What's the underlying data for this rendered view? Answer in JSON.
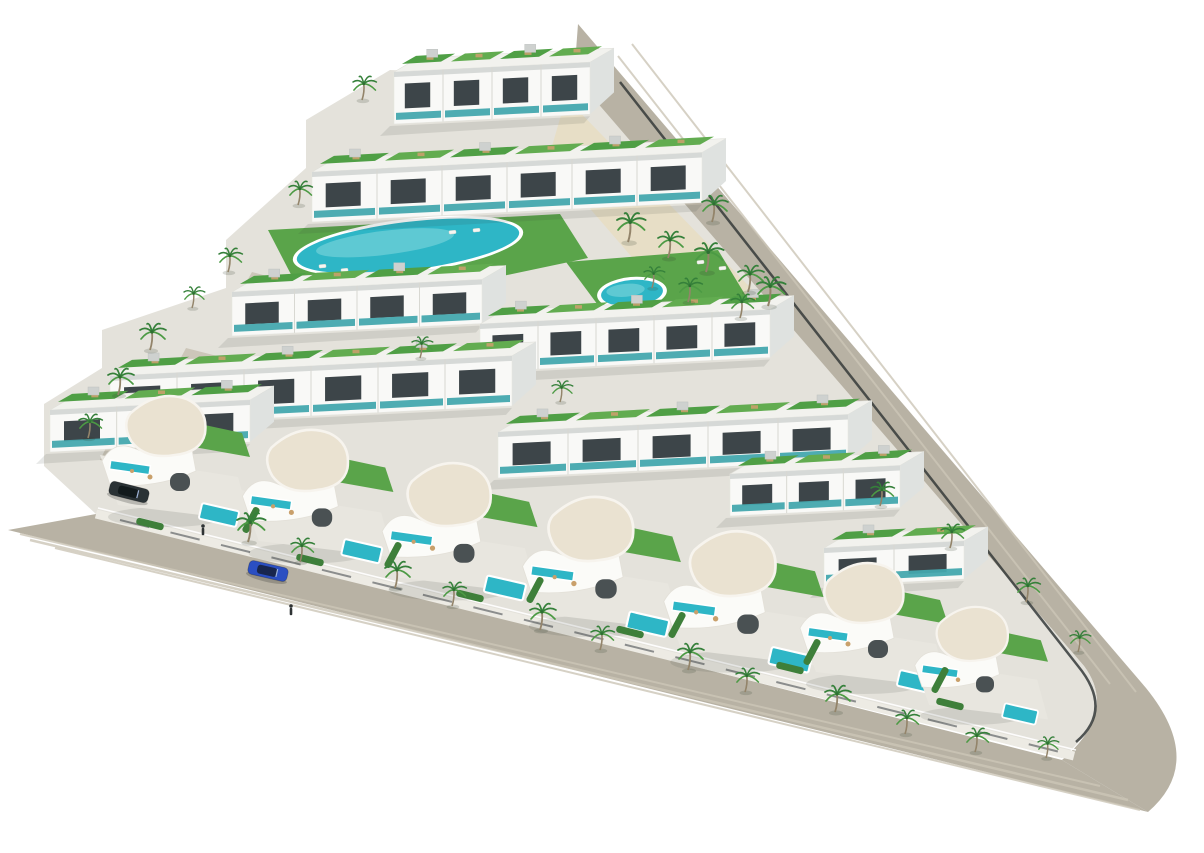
{
  "scene": {
    "alt": "Aerial 3D render of a triangular residential development with rows of white apartments with green roof terraces, two communal pools, curved white villas with private pools, palm trees and perimeter roads",
    "width": 1204,
    "height": 853,
    "palette": {
      "background": "#ffffff",
      "road": "#b8b2a4",
      "road_stripe": "#ccc6b7",
      "plot": "#e4e2db",
      "sidewalk": "#edebe4",
      "sand": "#e7dec6",
      "lawn": "#5aa44a",
      "lawn_dark": "#3e7f3a",
      "roof_green_a": "#4f9f45",
      "roof_green_b": "#62ac50",
      "building": "#f9f9f7",
      "building_side": "#dfe2e0",
      "building_trim": "#d6d9d7",
      "roof_slab": "#f2f2ee",
      "window": "#3d4549",
      "glass_teal": "#44a8ae",
      "pool": "#2eb6c6",
      "pool_light": "#86d9de",
      "pool_rim": "#ffffff",
      "villa_roof": "#eae2d1",
      "villa_wall": "#fbfbf8",
      "terrace": "#e8e6df",
      "palm_frond": "#35803a",
      "palm_frond_light": "#4c9a44",
      "palm_trunk": "#93846a",
      "car_blue": "#2b4fc2",
      "car_blue_glass": "#18264e",
      "car_dark": "#2a3235",
      "car_dark_glass": "#121a1c",
      "fence": "#35393a",
      "furniture_tan": "#c9a06b",
      "lounger_white": "#f6f6f2",
      "shadow": "rgba(60,65,60,0.12)",
      "person": "#2f3335"
    },
    "roads": {
      "right_d": "M 578,24 L 1146,688 Q 1206,762 1148,812 L 1062,760 Q 1118,712 1084,666 L 574,78 Z",
      "bottom_d": "M 8,530 L 1148,812 L 1062,760 L 96,514 Z",
      "stripes": [
        {
          "d": "M 632,44 L 1136,692",
          "w": 2
        },
        {
          "d": "M 618,56 L 1110,684",
          "w": 2
        },
        {
          "d": "M 30,540 L 1128,800",
          "w": 2.5
        },
        {
          "d": "M 55,548 L 1140,810",
          "w": 2
        },
        {
          "d": "M 20,534 L 1100,786",
          "w": 2
        }
      ],
      "sidewalk_d": "M 96,514 L 1074,756",
      "sidewalk_edge_d": "M 98,508 L 1076,750",
      "wall_dash_d": "M 120,520 L 1060,752",
      "fence_d": "M 620,82 L 1078,666 Q 1114,710 1076,742"
    },
    "plot_d": "M 576,78 L 1084,666 Q 1118,712 1062,758 L 96,514 L 44,466 L 44,404 L 102,368 L 102,330 L 226,288 L 226,240 L 306,168 L 306,120 L 390,70 Z",
    "sand_points": "566,98 776,314 700,336 548,160",
    "lawns": [
      {
        "name": "main-pool-lawn",
        "points": "268,230 560,214 588,258 474,282 298,288"
      },
      {
        "name": "round-pool-lawn",
        "points": "566,262 718,250 752,306 612,324"
      }
    ],
    "driveways": [
      "118,424 190,442 172,478 100,460",
      "186,348 256,366 240,400 168,382",
      "252,272 318,290 302,322 234,304"
    ],
    "pools": [
      {
        "name": "main-lap-pool",
        "cx": 408,
        "cy": 246,
        "rx": 112,
        "ry": 24,
        "rot": -7
      },
      {
        "name": "round-pool",
        "cx": 632,
        "cy": 293,
        "rx": 31,
        "ry": 13,
        "rot": -5
      }
    ],
    "loungers": [
      [
        322,
        266
      ],
      [
        344,
        270
      ],
      [
        366,
        274
      ],
      [
        452,
        232
      ],
      [
        476,
        230
      ],
      [
        586,
        312
      ],
      [
        612,
        318
      ],
      [
        648,
        316
      ],
      [
        668,
        306
      ],
      [
        700,
        262
      ],
      [
        722,
        268
      ]
    ],
    "blocks": [
      {
        "name": "apartment-row-a",
        "x": 394,
        "y": 72,
        "w": 196,
        "h": 52,
        "units": 4
      },
      {
        "name": "apartment-row-b",
        "x": 312,
        "y": 172,
        "w": 390,
        "h": 50,
        "units": 6
      },
      {
        "name": "apartment-tower-c",
        "x": 232,
        "y": 292,
        "w": 250,
        "h": 44,
        "units": 4
      },
      {
        "name": "apartment-mid-block",
        "x": 480,
        "y": 324,
        "w": 290,
        "h": 48,
        "units": 5
      },
      {
        "name": "apartment-row-d",
        "x": 110,
        "y": 376,
        "w": 402,
        "h": 50,
        "units": 6
      },
      {
        "name": "apartment-row-d2",
        "x": 498,
        "y": 432,
        "w": 350,
        "h": 46,
        "units": 5
      },
      {
        "name": "apartment-row-e",
        "x": 50,
        "y": 410,
        "w": 200,
        "h": 42,
        "units": 3
      },
      {
        "name": "apartment-row-r1",
        "x": 730,
        "y": 474,
        "w": 170,
        "h": 42,
        "units": 3
      },
      {
        "name": "apartment-row-r2",
        "x": 824,
        "y": 548,
        "w": 140,
        "h": 38,
        "units": 2
      }
    ],
    "villas": [
      {
        "x": 180,
        "y": 455,
        "s": 1.0
      },
      {
        "x": 322,
        "y": 490,
        "s": 1.02
      },
      {
        "x": 464,
        "y": 525,
        "s": 1.05
      },
      {
        "x": 606,
        "y": 560,
        "s": 1.07
      },
      {
        "x": 748,
        "y": 595,
        "s": 1.08
      },
      {
        "x": 878,
        "y": 622,
        "s": 1.0
      },
      {
        "x": 985,
        "y": 660,
        "s": 0.9
      }
    ],
    "hedges": [
      [
        251,
        520,
        -62
      ],
      [
        393,
        555,
        -62
      ],
      [
        535,
        590,
        -62
      ],
      [
        677,
        625,
        -62
      ],
      [
        812,
        652,
        -62
      ],
      [
        940,
        680,
        -62
      ],
      [
        150,
        524,
        14
      ],
      [
        310,
        560,
        14
      ],
      [
        470,
        596,
        14
      ],
      [
        630,
        632,
        14
      ],
      [
        790,
        668,
        14
      ],
      [
        950,
        704,
        14
      ]
    ],
    "palms": [
      [
        362,
        100,
        0.9
      ],
      [
        298,
        205,
        0.9
      ],
      [
        712,
        222,
        1.0
      ],
      [
        228,
        272,
        0.9
      ],
      [
        628,
        242,
        1.1
      ],
      [
        668,
        258,
        1.0
      ],
      [
        706,
        272,
        1.1
      ],
      [
        748,
        292,
        1.0
      ],
      [
        768,
        306,
        1.1
      ],
      [
        740,
        318,
        0.9
      ],
      [
        688,
        302,
        0.9
      ],
      [
        652,
        288,
        0.8
      ],
      [
        150,
        350,
        1.0
      ],
      [
        118,
        395,
        1.0
      ],
      [
        88,
        438,
        0.9
      ],
      [
        192,
        308,
        0.8
      ],
      [
        420,
        358,
        0.8
      ],
      [
        560,
        402,
        0.8
      ],
      [
        248,
        542,
        1.1
      ],
      [
        300,
        562,
        0.9
      ],
      [
        395,
        588,
        1.0
      ],
      [
        452,
        606,
        0.9
      ],
      [
        540,
        630,
        1.0
      ],
      [
        600,
        650,
        0.9
      ],
      [
        688,
        670,
        1.0
      ],
      [
        745,
        692,
        0.9
      ],
      [
        835,
        712,
        1.0
      ],
      [
        905,
        734,
        0.9
      ],
      [
        975,
        752,
        0.9
      ],
      [
        1046,
        758,
        0.8
      ],
      [
        880,
        506,
        0.9
      ],
      [
        950,
        548,
        0.9
      ],
      [
        1026,
        602,
        0.9
      ],
      [
        1078,
        652,
        0.8
      ]
    ],
    "cars": [
      {
        "name": "blue-car",
        "x": 268,
        "y": 571,
        "rot": 13,
        "body": "car_blue",
        "glass": "car_blue_glass"
      },
      {
        "name": "parked-dark-car",
        "x": 129,
        "y": 492,
        "rot": 14,
        "body": "car_dark",
        "glass": "car_dark_glass"
      }
    ],
    "people": [
      [
        203,
        532
      ],
      [
        291,
        612
      ]
    ]
  }
}
